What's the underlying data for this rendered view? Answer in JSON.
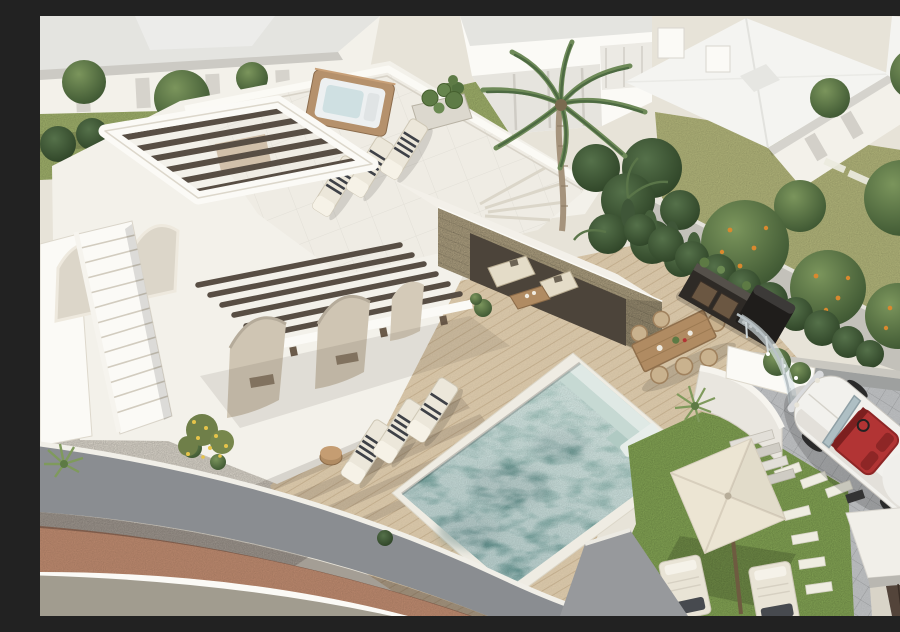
{
  "scene": {
    "type": "aerial-architectural-render",
    "description": "Aerial 3D render of a modern Ibiza-style white villa: rooftop terrace with hot tub, pergola and sun loungers, stone outdoor lounge pavilion, wooden pool deck with turquoise plunge pool and steps, alfresco dining table with six chairs, outdoor kitchen against a green hedge, lawn with cream parasol and loungers, paver driveway with a white classic convertible with red interior, curved grey perimeter wall with terracotta sidewalk, neighbouring white villas, palm and orange trees.",
    "objects": [
      {
        "id": "main-villa",
        "label": "white Ibiza-style villa"
      },
      {
        "id": "rooftop-terrace",
        "label": "rooftop terrace"
      },
      {
        "id": "hot-tub",
        "label": "wood-clad hot tub"
      },
      {
        "id": "rooftop-pergola",
        "label": "dark beam pergola"
      },
      {
        "id": "stone-pavilion",
        "label": "stone outdoor lounge pavilion"
      },
      {
        "id": "pool",
        "label": "turquoise plunge pool with steps"
      },
      {
        "id": "pool-deck",
        "label": "light wood deck"
      },
      {
        "id": "dining-set",
        "label": "outdoor dining table"
      },
      {
        "id": "outdoor-kitchen",
        "label": "dark outdoor kitchen / bbq"
      },
      {
        "id": "parasol",
        "label": "cream square parasol"
      },
      {
        "id": "classic-car",
        "label": "white classic convertible, red interior"
      },
      {
        "id": "driveway",
        "label": "grey paver driveway"
      },
      {
        "id": "perimeter-wall",
        "label": "curved grey boundary wall"
      },
      {
        "id": "palm-tree",
        "label": "tall palm tree"
      },
      {
        "id": "orange-trees",
        "label": "orange trees behind wall"
      },
      {
        "id": "neighbour-villas",
        "label": "neighbouring white villas"
      }
    ],
    "counts": {
      "rooftop_loungers": 3,
      "deck_loungers": 3,
      "lawn_loungers": 2,
      "dining_chairs": 6,
      "pool_steps": 3
    }
  },
  "palette": {
    "bg": "#e7e3d8",
    "white-wall": "#f3f1ea",
    "white-bright": "#fbfaf6",
    "wall-shade": "#d9d4c8",
    "roof-light": "#e4e4e0",
    "roof-white": "#f4f4f1",
    "deck-wood": "#d8c6a8",
    "stone": "#a5987a",
    "pool-light": "#a3c6bd",
    "pool-dark": "#679592",
    "pool-step": "#dfe9e5",
    "grass-bright": "#7d9c50",
    "grass-olive": "#a9ac74",
    "grass-lawn": "#97a765",
    "tree-green": "#4f6b3c",
    "tree-dark": "#38512d",
    "pergola-beam": "#584e44",
    "wood-warm": "#b08b62",
    "hot-tub-wood": "#b5916c",
    "interior-dark": "#4c443a",
    "sofa-cream": "#e4dcc8",
    "car-red": "#b23434",
    "paver": "#b9bbbd",
    "glass": "#dde8eb",
    "wall-grey": "#8a8d91",
    "terracotta": "#b5846a",
    "road": "#a19c8f",
    "gravel": "#d0cbc1",
    "towel-dark": "#3e4147",
    "umbrella": "#ece5d3",
    "orange": "#d9892f",
    "yellow-flower": "#e6c44a"
  }
}
